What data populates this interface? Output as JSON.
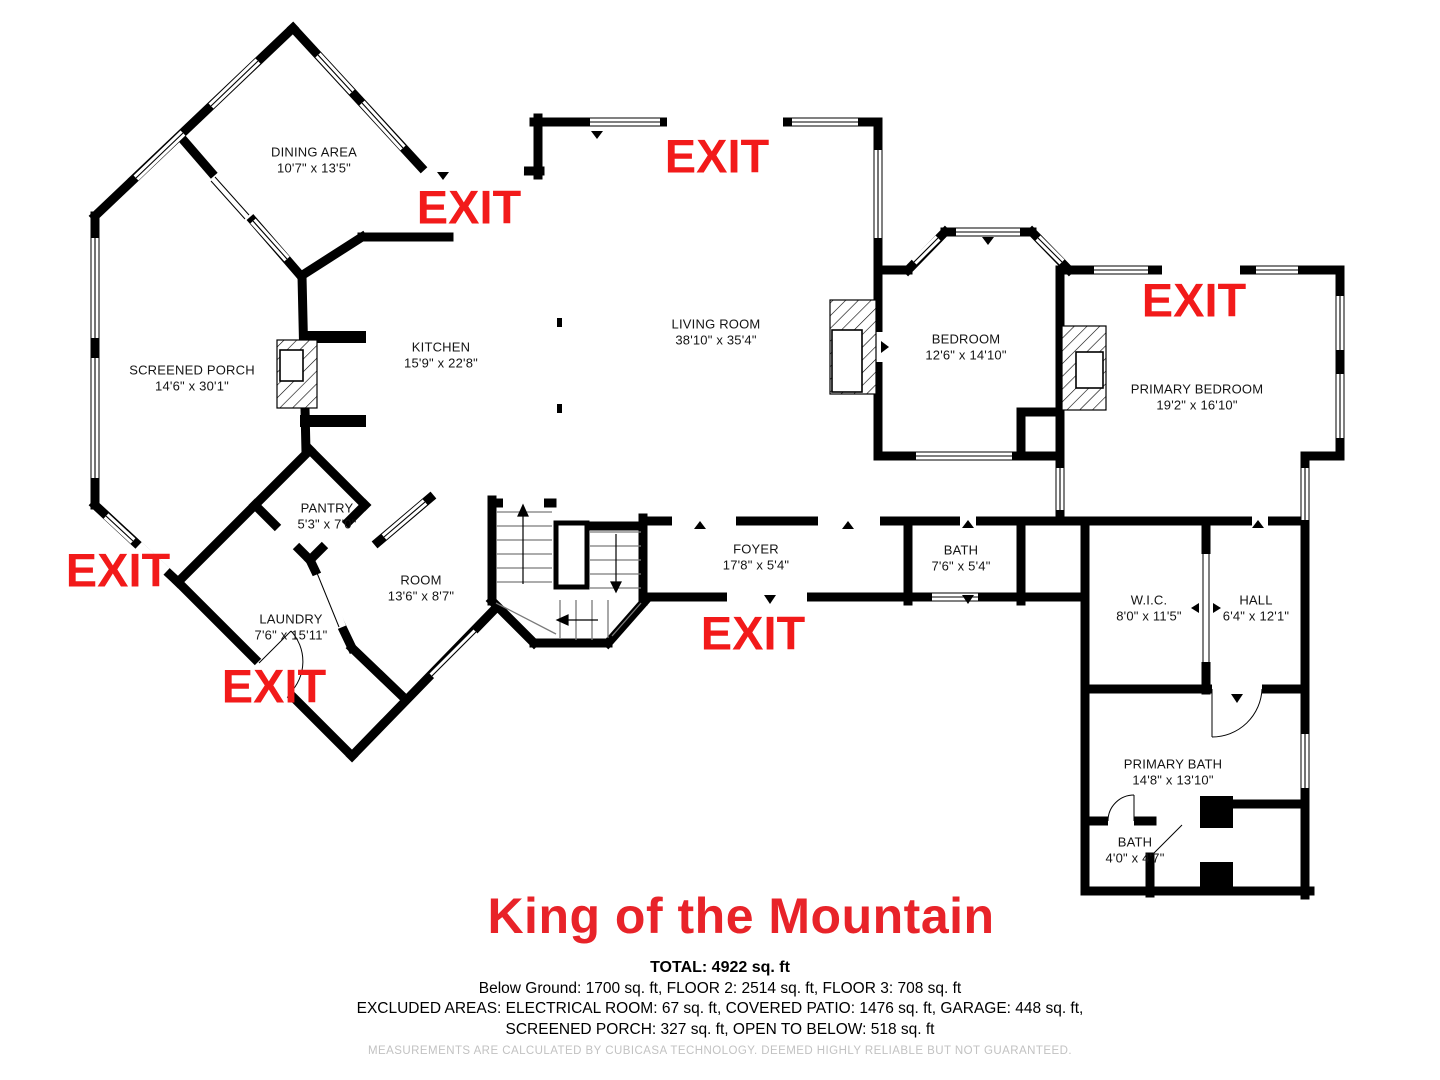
{
  "title": {
    "text": "King of the Mountain"
  },
  "colors": {
    "exit_red": "#f21a1a",
    "title_red": "#e82329",
    "wall_black": "#000000",
    "disclaimer_gray": "#c2c2c2"
  },
  "floorplan": {
    "exit_label": "EXIT",
    "exits_count": 6,
    "rooms": [
      {
        "name": "DINING AREA",
        "dims": "10'7\" x 13'5\""
      },
      {
        "name": "SCREENED PORCH",
        "dims": "14'6\" x 30'1\""
      },
      {
        "name": "KITCHEN",
        "dims": "15'9\" x 22'8\""
      },
      {
        "name": "LIVING ROOM",
        "dims": "38'10\" x 35'4\""
      },
      {
        "name": "BEDROOM",
        "dims": "12'6\" x 14'10\""
      },
      {
        "name": "PRIMARY BEDROOM",
        "dims": "19'2\" x 16'10\""
      },
      {
        "name": "PANTRY",
        "dims": "5'3\" x 7'0\""
      },
      {
        "name": "ROOM",
        "dims": "13'6\" x 8'7\""
      },
      {
        "name": "LAUNDRY",
        "dims": "7'6\" x 15'11\""
      },
      {
        "name": "FOYER",
        "dims": "17'8\" x 5'4\""
      },
      {
        "name": "BATH",
        "dims": "7'6\" x 5'4\""
      },
      {
        "name": "W.I.C.",
        "dims": "8'0\" x 11'5\""
      },
      {
        "name": "HALL",
        "dims": "6'4\" x 12'1\""
      },
      {
        "name": "PRIMARY BATH",
        "dims": "14'8\" x 13'10\""
      },
      {
        "name": "BATH",
        "dims": "4'0\" x 4'7\""
      }
    ]
  },
  "summary": {
    "total": "TOTAL: 4922 sq. ft",
    "line2": "Below Ground: 1700 sq. ft, FLOOR 2: 2514 sq. ft, FLOOR 3: 708 sq. ft",
    "line3": "EXCLUDED AREAS: ELECTRICAL ROOM: 67 sq. ft, COVERED PATIO: 1476 sq. ft, GARAGE: 448 sq. ft,",
    "line4": "SCREENED PORCH: 327 sq. ft, OPEN TO BELOW: 518 sq. ft"
  },
  "disclaimer": "MEASUREMENTS ARE CALCULATED BY CUBICASA TECHNOLOGY. DEEMED HIGHLY RELIABLE BUT NOT GUARANTEED."
}
